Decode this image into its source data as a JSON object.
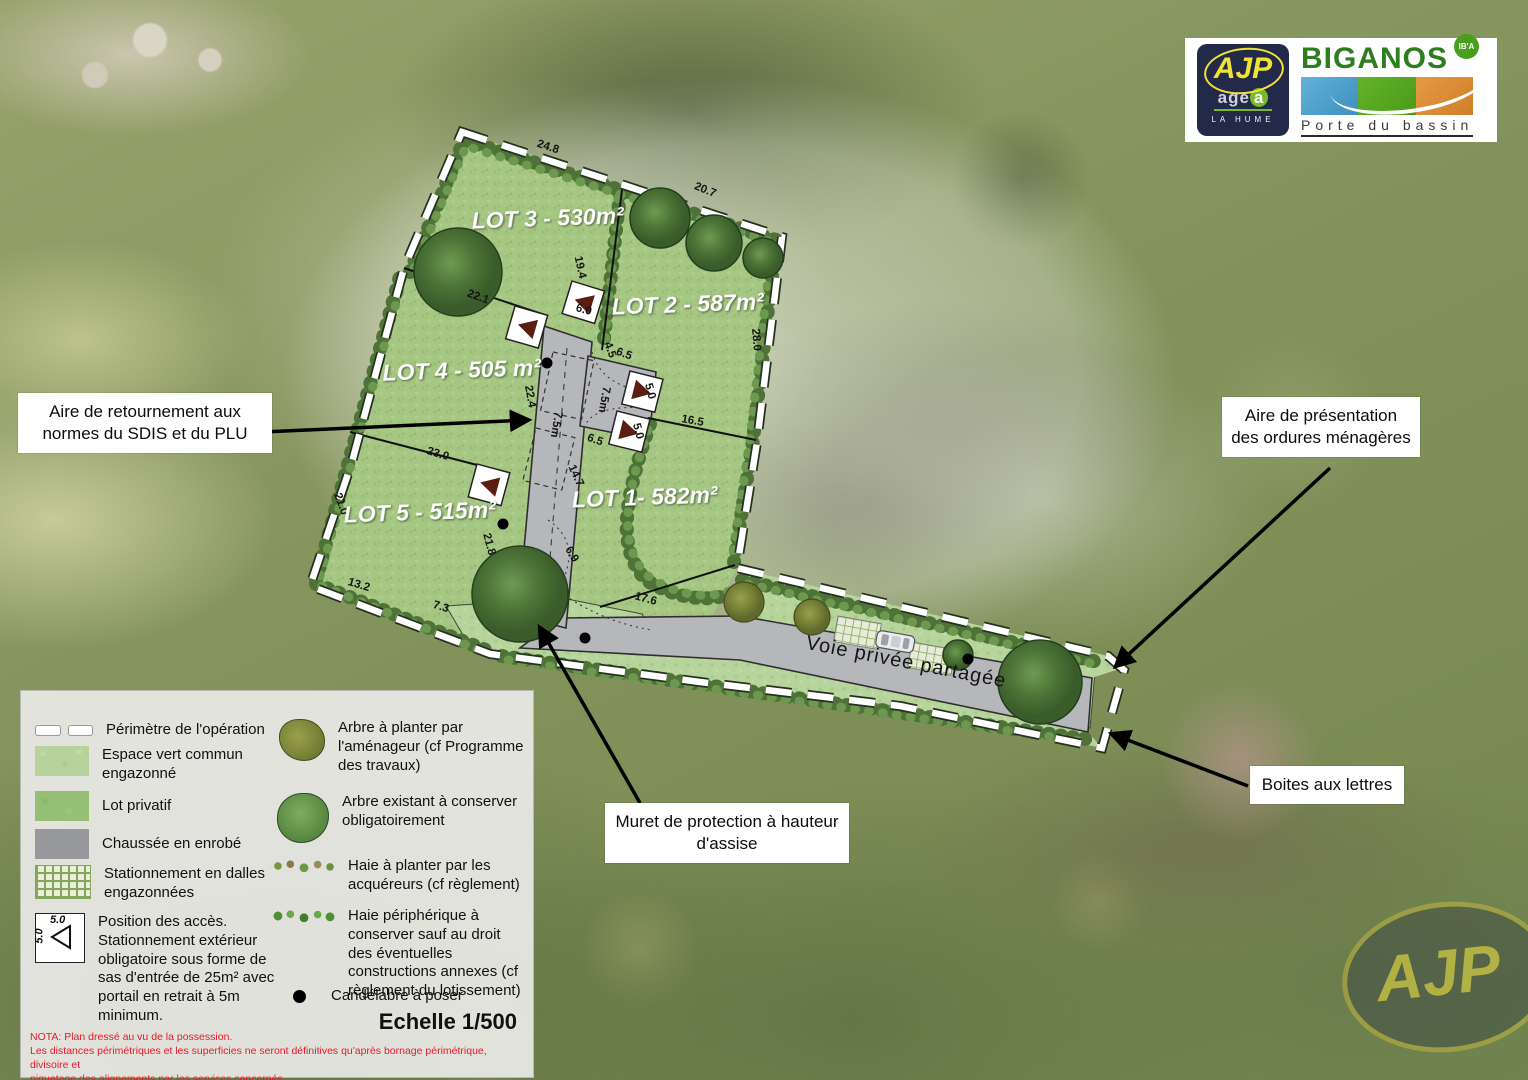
{
  "colors": {
    "plan_green": "#a6c683",
    "espace_vert": "#b6d49c",
    "road_grey": "#b6b7ba",
    "hedge_green": "#4e7238",
    "nota_red": "#e8192c",
    "ajp_navy": "#232949",
    "ajp_yellow": "#f1e334",
    "biganos_green": "#2e7d1e"
  },
  "logos": {
    "ajp": {
      "name": "AJP",
      "sub_prefix": "age",
      "sub_suffix": "a",
      "place": "LA HUME"
    },
    "biganos": {
      "name": "BIGANOS",
      "tagline": "Porte du bassin",
      "badge": "IB'A"
    }
  },
  "annotations": {
    "retournement": "Aire de retournement aux normes du SDIS et du PLU",
    "ordures": "Aire de présentation des ordures ménagères",
    "boites": "Boites aux lettres",
    "muret": "Muret de protection à hauteur d'assise"
  },
  "plan": {
    "road_label": "Voie privée partagée",
    "lots": [
      {
        "label": "LOT 3 - 530m²"
      },
      {
        "label": "LOT 2 - 587m²"
      },
      {
        "label": "LOT 4 - 505 m²"
      },
      {
        "label": "LOT 5 - 515m²"
      },
      {
        "label": "LOT 1- 582m²"
      }
    ],
    "dimensions": [
      {
        "text": "24.8"
      },
      {
        "text": "20.7"
      },
      {
        "text": "19.4"
      },
      {
        "text": "22.1"
      },
      {
        "text": "6.0"
      },
      {
        "text": "4.5"
      },
      {
        "text": "6.5"
      },
      {
        "text": "5.0"
      },
      {
        "text": "5.0"
      },
      {
        "text": "16.5"
      },
      {
        "text": "28.0"
      },
      {
        "text": "22.4"
      },
      {
        "text": "23.0"
      },
      {
        "text": "21.8"
      },
      {
        "text": "14.7"
      },
      {
        "text": "6.5"
      },
      {
        "text": "6.9"
      },
      {
        "text": "17.6"
      },
      {
        "text": "13.2"
      },
      {
        "text": "7.3"
      },
      {
        "text": "21.0"
      },
      {
        "text": "7.5m"
      },
      {
        "text": "7.5m"
      }
    ]
  },
  "legend": {
    "items_left": [
      {
        "label": "Périmètre de l'opération"
      },
      {
        "label": "Espace vert commun engazonné"
      },
      {
        "label": "Lot privatif"
      },
      {
        "label": "Chaussée en enrobé"
      },
      {
        "label": "Stationnement en dalles engazonnées"
      },
      {
        "label": "Position des accès. Stationnement extérieur obligatoire sous forme de sas d'entrée de 25m² avec portail en retrait à 5m minimum.",
        "icon_top": "5.0",
        "icon_side": "5.0"
      }
    ],
    "items_right": [
      {
        "label": "Arbre à planter par l'aménageur (cf Programme des travaux)"
      },
      {
        "label": "Arbre existant à conserver obligatoirement"
      },
      {
        "label": "Haie à planter par les acquéreurs (cf règlement)"
      },
      {
        "label": "Haie périphérique à conserver sauf au droit des éventuelles constructions annexes (cf règlement du lotissement)"
      },
      {
        "label": "Candélabre à poser"
      }
    ],
    "scale": "Echelle 1/500",
    "nota": "NOTA: Plan dressé au vu de la possession.\nLes distances périmétriques et les superficies ne seront définitives qu'après bornage périmétrique, divisoire et\npiquetage des alignements par les services concernés."
  },
  "watermark": "AJP"
}
